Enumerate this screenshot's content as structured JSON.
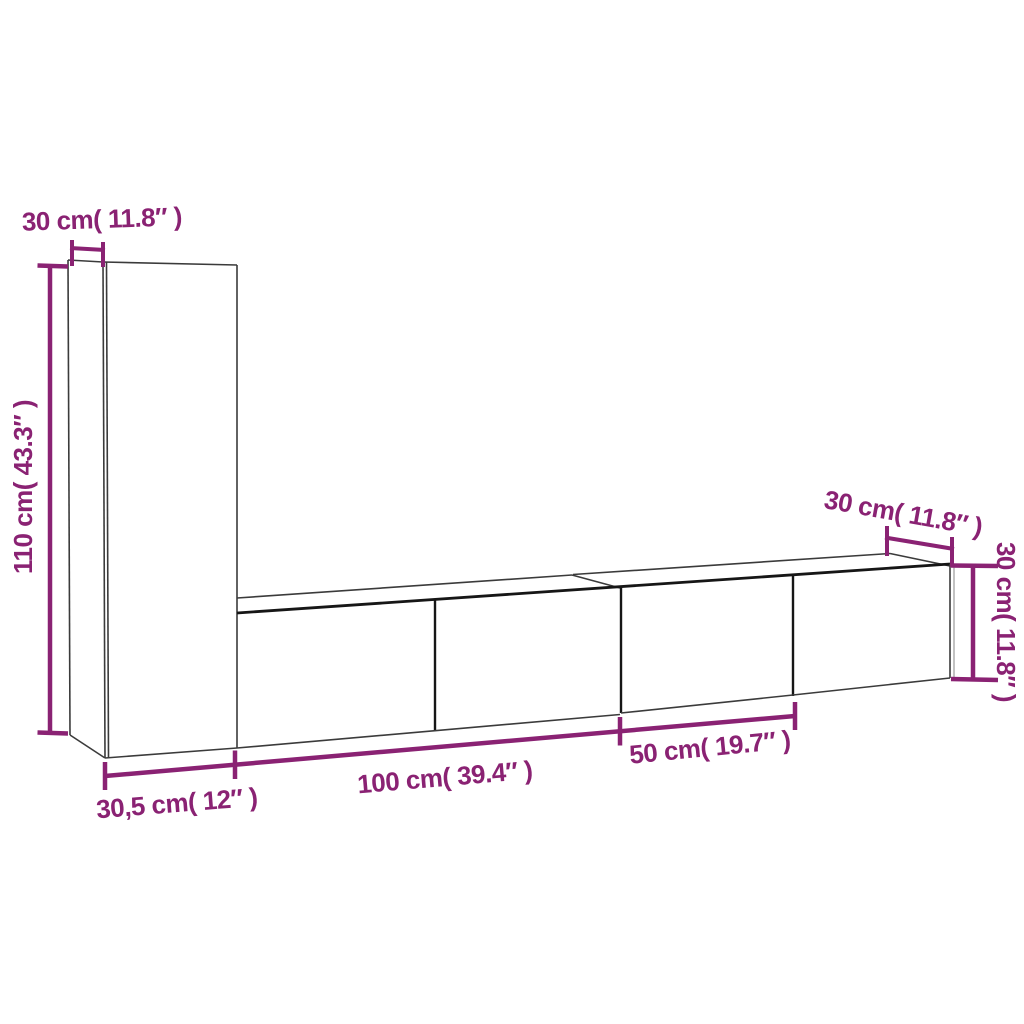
{
  "diagram": {
    "title": "TV wall cabinet set dimension diagram",
    "background_color": "#ffffff",
    "accent_color": "#8A2273",
    "outline_color": "#3b3b3b",
    "heavy_outline_color": "#161616",
    "dimensions": [
      {
        "id": "top-left-depth",
        "label": "30 cm( 11.8″ )",
        "cm": "30",
        "inches": "11.8",
        "placement": "above tall cabinet side panel"
      },
      {
        "id": "left-height",
        "label": "110 cm( 43.3″ )",
        "cm": "110",
        "inches": "43.3",
        "placement": "left of tall cabinet, rotated"
      },
      {
        "id": "bottom-left-width",
        "label": "30,5 cm( 12″ )",
        "cm": "30,5",
        "inches": "12",
        "placement": "below tall cabinet front"
      },
      {
        "id": "bottom-mid-width",
        "label": "100 cm( 39.4″ )",
        "cm": "100",
        "inches": "39.4",
        "placement": "below long TV cabinet"
      },
      {
        "id": "bottom-right-width",
        "label": "50 cm( 19.7″ )",
        "cm": "50",
        "inches": "19.7",
        "placement": "below short TV cabinet"
      },
      {
        "id": "top-right-depth",
        "label": "30 cm( 11.8″ )",
        "cm": "30",
        "inches": "11.8",
        "placement": "above right cabinet top edge"
      },
      {
        "id": "right-height",
        "label": "30 cm( 11.8″ )",
        "cm": "30",
        "inches": "11.8",
        "placement": "right of right cabinet, rotated"
      }
    ]
  }
}
